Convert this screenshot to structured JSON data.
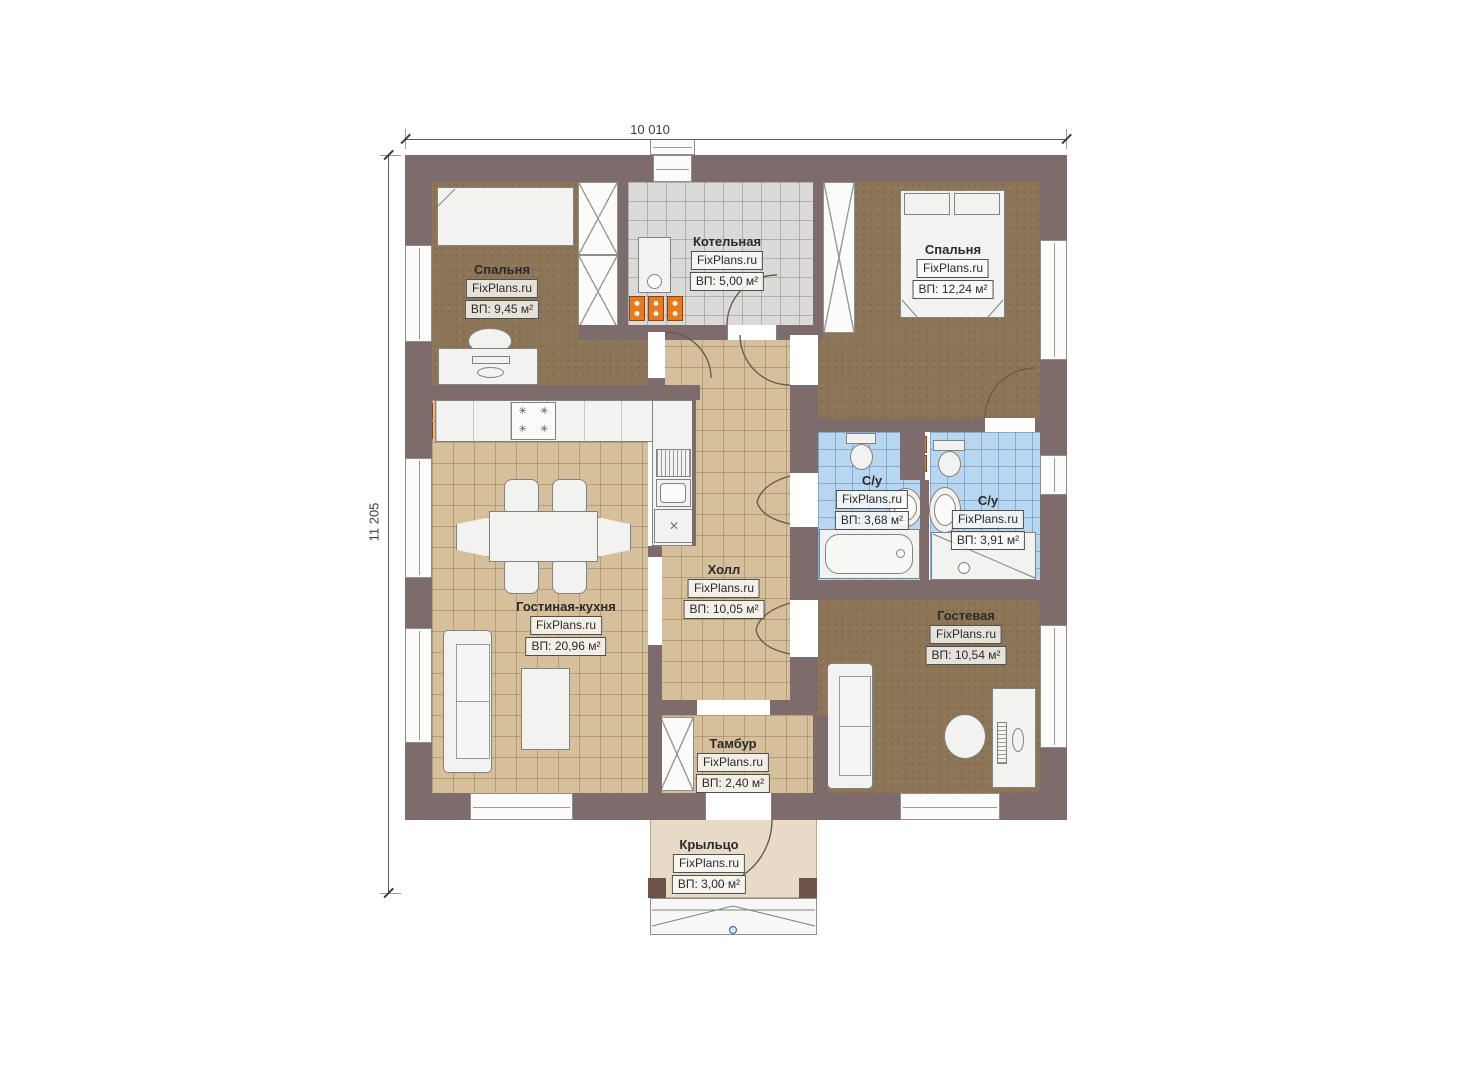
{
  "watermark": "FixPlans.ru",
  "dimensions": {
    "width_label": "10 010",
    "height_label": "11 205"
  },
  "rooms": [
    {
      "id": "bedroom-1",
      "name": "Спальня",
      "area": "ВП: 9,45 м²"
    },
    {
      "id": "boiler-room",
      "name": "Котельная",
      "area": "ВП: 5,00 м²"
    },
    {
      "id": "bedroom-2",
      "name": "Спальня",
      "area": "ВП: 12,24 м²"
    },
    {
      "id": "bathroom-1",
      "name": "С/у",
      "area": "ВП: 3,68 м²"
    },
    {
      "id": "bathroom-2",
      "name": "С/у",
      "area": "ВП: 3,91 м²"
    },
    {
      "id": "hall",
      "name": "Холл",
      "area": "ВП: 10,05 м²"
    },
    {
      "id": "living-kitchen",
      "name": "Гостиная-кухня",
      "area": "ВП: 20,96 м²"
    },
    {
      "id": "guest-room",
      "name": "Гостевая",
      "area": "ВП: 10,54 м²"
    },
    {
      "id": "vestibule",
      "name": "Тамбур",
      "area": "ВП: 2,40 м²"
    },
    {
      "id": "porch",
      "name": "Крыльцо",
      "area": "ВП: 3,00 м²"
    }
  ],
  "icons": {
    "stove_burner": "✳",
    "dishwasher_mark": "✕"
  },
  "colors": {
    "wall": "#7e6c6c",
    "wood_floor": "#8d7557",
    "tile_beige": "#d6c09b",
    "tile_gray": "#dadad8",
    "tile_blue": "#b8d6ef",
    "porch_floor": "#e7dbc8",
    "radiator": "#e8791e",
    "furniture": "#f2f2f0",
    "marker_blue": "#3f6db5"
  }
}
